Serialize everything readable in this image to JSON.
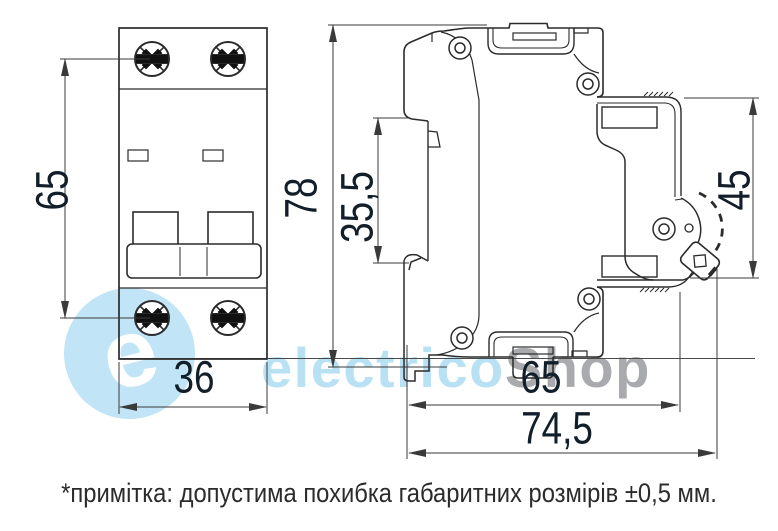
{
  "dimensions": {
    "front_height": "65",
    "front_width": "36",
    "overall_height": "78",
    "din_clip_height": "35,5",
    "right_side_height": "45",
    "base_depth": "65",
    "overall_depth": "74,5"
  },
  "note": {
    "text": "*примітка: допустима похибка габаритних розмірів ±0,5 мм."
  },
  "watermark": {
    "logo_letter": "e",
    "brand_primary": "electrico",
    "brand_secondary": "Shop"
  },
  "colors": {
    "line": "#2b2b2b",
    "dim_line": "#3a3a3a",
    "dim_text": "#121e29",
    "note_text": "#2b2b2b",
    "watermark_disc": "#c1e4f6",
    "watermark_text": "#b9e1f4",
    "watermark_gray": "#a8aaad",
    "background": "#ffffff"
  }
}
